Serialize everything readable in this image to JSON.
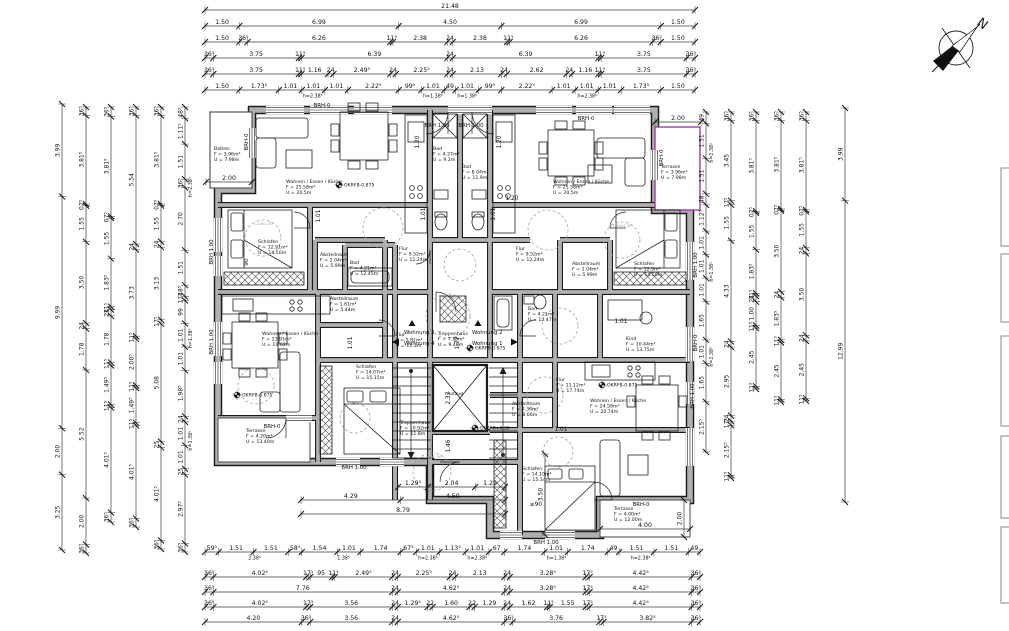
{
  "compass": {
    "label": "N"
  },
  "colors": {
    "line": "#1c1c1c",
    "wall_fill": "#b0b0b0",
    "chain": "#3a3a3a",
    "terrace_accent": "#a836a8",
    "dashed": "#9a9a9a"
  },
  "chains": [
    {
      "id": "t1",
      "dir": "h",
      "x": 205,
      "y": 10,
      "len": 490,
      "labels": [
        "21.48"
      ]
    },
    {
      "id": "t2",
      "dir": "h",
      "x": 205,
      "y": 26,
      "len": 490,
      "labels": [
        "1.50",
        "6.99",
        "4.50",
        "6.99",
        "1.50"
      ]
    },
    {
      "id": "t3",
      "dir": "h",
      "x": 205,
      "y": 42,
      "len": 490,
      "labels": [
        "1.50",
        "36⁵",
        "6.26",
        "11⁵",
        "2.38",
        "24",
        "2.38",
        "11⁵",
        "6.26",
        "36⁵",
        "1.50"
      ]
    },
    {
      "id": "t4",
      "dir": "h",
      "x": 205,
      "y": 58,
      "len": 490,
      "labels": [
        "36⁵",
        "3.75",
        "11⁵",
        "6.39",
        "24",
        "6.39",
        "11⁵",
        "3.75",
        "36⁵"
      ]
    },
    {
      "id": "t5",
      "dir": "h",
      "x": 205,
      "y": 74,
      "len": 490,
      "labels": [
        "36⁵",
        "3.75",
        "11⁵",
        "1.16",
        "24",
        "2.49⁵",
        "24",
        "2.25⁵",
        "24",
        "2.13",
        "24",
        "2.62",
        "24",
        "1.16",
        "11⁵",
        "3.75",
        "36⁵"
      ]
    },
    {
      "id": "t6",
      "dir": "h",
      "x": 205,
      "y": 90,
      "len": 490,
      "labels": [
        "1.50",
        "1.73⁵",
        "1.01",
        "1.01",
        "1.01",
        "2.22⁵",
        "99⁵",
        "1.01",
        "49",
        "1.01",
        "99⁵",
        "2.22⁵",
        "1.01",
        "1.01",
        "1.01",
        "1.73⁵",
        "1.50"
      ],
      "ann": [
        {
          "t": "h=2.38⁵",
          "f": 0.22
        },
        {
          "t": "h=1.38⁵",
          "f": 0.465
        },
        {
          "t": "h=1.38⁵",
          "f": 0.535
        },
        {
          "t": "h=2.38⁵",
          "f": 0.78
        }
      ]
    },
    {
      "id": "b1",
      "dir": "h",
      "x": 205,
      "y": 552,
      "len": 495,
      "labels": [
        "59⁵",
        "1.51",
        "1.51",
        "58⁵",
        "1.54",
        "1.01",
        "1.74",
        "67⁵",
        "1.01",
        "1.13⁵",
        "1.01",
        "67",
        "1.74",
        "1.01",
        "1.74",
        "49",
        "1.51",
        "1.51",
        "49"
      ],
      "ann": [
        {
          "t": "2.38⁵",
          "f": 0.1
        },
        {
          "t": "1.38⁵",
          "f": 0.28
        },
        {
          "t": "h=2.38⁵",
          "f": 0.45
        },
        {
          "t": "h=2.38⁵",
          "f": 0.55
        },
        {
          "t": "h=1.38⁵",
          "f": 0.71
        },
        {
          "t": "h=2.38⁵",
          "f": 0.88
        }
      ]
    },
    {
      "id": "b2",
      "dir": "h",
      "x": 205,
      "y": 577,
      "len": 495,
      "labels": [
        "36⁵",
        "4.02⁵",
        "17⁵",
        "95",
        "11⁵",
        "2.49⁵",
        "24",
        "2.25⁵",
        "24",
        "2.13",
        "24",
        "3.28⁵",
        "17⁵",
        "4.42⁵",
        "36⁵"
      ]
    },
    {
      "id": "b3",
      "dir": "h",
      "x": 205,
      "y": 592,
      "len": 495,
      "labels": [
        "36⁵",
        "7.76",
        "24",
        "4.62⁵",
        "24",
        "3.28⁵",
        "17⁵",
        "4.42⁵",
        "36⁵"
      ]
    },
    {
      "id": "b4",
      "dir": "h",
      "x": 205,
      "y": 607,
      "len": 495,
      "labels": [
        "36⁵",
        "4.02⁵",
        "17⁵",
        "3.56",
        "24",
        "1.29⁵",
        "22",
        "1.60",
        "22",
        "1.29",
        "24",
        "1.62",
        "11⁵",
        "1.55",
        "17⁵",
        "4.42⁵",
        "36⁵"
      ]
    },
    {
      "id": "b5",
      "dir": "h",
      "x": 205,
      "y": 622,
      "len": 495,
      "labels": [
        "4.20",
        "36⁵",
        "3.56",
        "24",
        "4.62⁵",
        "36⁵",
        "3.76",
        "17⁵",
        "3.82⁵",
        "36⁵"
      ]
    },
    {
      "id": "l1",
      "dir": "v",
      "x": 62,
      "y": 104,
      "len": 446,
      "labels": [
        "3.99",
        "9.99",
        "2.00",
        "3.25"
      ]
    },
    {
      "id": "l2",
      "dir": "v",
      "x": 86,
      "y": 107,
      "len": 446,
      "labels": [
        "36⁵",
        "3.81⁵",
        "07⁵",
        "1.55",
        "3.50",
        "24",
        "1.78",
        "5.52",
        "2.00",
        "36⁵"
      ]
    },
    {
      "id": "l3",
      "dir": "v",
      "x": 111,
      "y": 107,
      "len": 415,
      "labels": [
        "36⁵",
        "3.81⁵",
        "07⁵",
        "1.55",
        "1.83⁵",
        "11⁵",
        "24",
        "1.78",
        "11⁵",
        "1.49⁵",
        "11⁵",
        "4.01⁵",
        "36⁵"
      ]
    },
    {
      "id": "l4",
      "dir": "v",
      "x": 136,
      "y": 107,
      "len": 420,
      "labels": [
        "36⁵",
        "5.54",
        "24",
        "3.73",
        "11⁵",
        "2.00⁵",
        "11⁵",
        "1.49⁵",
        "11⁵",
        "4.01⁵",
        "36⁵"
      ]
    },
    {
      "id": "l5",
      "dir": "v",
      "x": 161,
      "y": 107,
      "len": 442,
      "labels": [
        "36⁵",
        "3.81⁵",
        "07⁵",
        "1.55",
        "24",
        "3.13",
        "17⁵",
        "5.08",
        "25",
        "4.01⁵",
        "36⁵"
      ]
    },
    {
      "id": "l6",
      "dir": "v",
      "x": 185,
      "y": 107,
      "len": 445,
      "labels": [
        "48⁵",
        "1.11⁵",
        "1.51",
        "36⁵",
        "2.70",
        "1.51",
        "48⁵",
        "17⁵",
        "99",
        "1.01",
        "1.01",
        "1.98⁵",
        "24",
        "1.01",
        "1.01",
        "25",
        "2.97⁵",
        "36⁵"
      ],
      "ann": [
        {
          "t": "h=2.38⁵",
          "f": 0.18
        },
        {
          "t": "h=1.38⁵",
          "f": 0.52
        },
        {
          "t": "h=1.38⁵",
          "f": 0.75
        }
      ]
    },
    {
      "id": "r1",
      "dir": "v",
      "x": 706,
      "y": 112,
      "len": 340,
      "labels": [
        "49",
        "1.51",
        "1.51",
        "48",
        "1.12⁵",
        "1.01",
        "1.01",
        "1.01",
        "1.65",
        "1.01",
        "1.65",
        "2.15⁵"
      ],
      "ann": [
        {
          "t": "h=2.38⁵",
          "f": 0.12
        },
        {
          "t": "h=1.38⁵",
          "f": 0.47
        },
        {
          "t": "h=2.38⁵",
          "f": 0.72
        }
      ]
    },
    {
      "id": "r2",
      "dir": "v",
      "x": 731,
      "y": 112,
      "len": 366,
      "labels": [
        "36⁵",
        "3.45",
        "17⁵",
        "1.55",
        "4.33",
        "24",
        "2.95",
        "24",
        "17⁵",
        "2.15⁵",
        "11⁵"
      ]
    },
    {
      "id": "r3",
      "dir": "v",
      "x": 756,
      "y": 112,
      "len": 277,
      "labels": [
        "36⁵",
        "3.81⁵",
        "07⁵",
        "1.55",
        "1.83⁵",
        "11⁵",
        "24",
        "1.00",
        "11⁵",
        "2.45",
        "11⁵"
      ]
    },
    {
      "id": "r4",
      "dir": "v",
      "x": 781,
      "y": 112,
      "len": 290,
      "labels": [
        "36⁵",
        "3.81⁵",
        "07⁵",
        "3.50",
        "24",
        "1.83⁵",
        "11⁵",
        "2.45",
        "11⁵"
      ]
    },
    {
      "id": "r5",
      "dir": "v",
      "x": 806,
      "y": 112,
      "len": 289,
      "labels": [
        "36⁵",
        "3.81⁵",
        "07⁵",
        "1.55",
        "24",
        "3.50",
        "24",
        "2.45",
        "11⁵"
      ]
    },
    {
      "id": "r6",
      "dir": "v",
      "x": 845,
      "y": 108,
      "len": 394,
      "labels": [
        "3.99",
        "12.99"
      ]
    },
    {
      "id": "p1",
      "dir": "h",
      "x": 398,
      "y": 487,
      "len": 107,
      "labels": [
        "1.29⁵",
        "2.04",
        "1.29"
      ]
    },
    {
      "id": "p2",
      "dir": "h",
      "x": 301,
      "y": 500,
      "len": 204,
      "labels": [
        "4.29",
        "4.50"
      ]
    },
    {
      "id": "p3",
      "dir": "h",
      "x": 301,
      "y": 514,
      "len": 204,
      "labels": [
        "8.79"
      ]
    },
    {
      "id": "p4",
      "dir": "v",
      "x": 545,
      "y": 454,
      "len": 81,
      "labels": [
        "3.50"
      ]
    },
    {
      "id": "p5",
      "dir": "h",
      "x": 600,
      "y": 529,
      "len": 90,
      "labels": [
        "4.00"
      ]
    },
    {
      "id": "p6",
      "dir": "v",
      "x": 684,
      "y": 500,
      "len": 37,
      "labels": [
        "2.00"
      ]
    },
    {
      "id": "p7",
      "dir": "h",
      "x": 655,
      "y": 122,
      "len": 46,
      "labels": [
        "2.00"
      ]
    },
    {
      "id": "p8",
      "dir": "h",
      "x": 206,
      "y": 182,
      "len": 46,
      "labels": [
        "2.00"
      ]
    }
  ],
  "rooms": [
    {
      "id": "balkon",
      "name": "Balkon",
      "area": "F = 3.96m²",
      "perim": "U = 7.98m",
      "x": 214,
      "y": 150
    },
    {
      "id": "wek-tl",
      "name": "Wohnen / Essen / Küche",
      "area": "F = 25.58m²",
      "perim": "U = 20.5m",
      "x": 286,
      "y": 183
    },
    {
      "id": "bad-1",
      "name": "Bad",
      "area": "F = 4.27m²",
      "perim": "U = 9.2m",
      "x": 433,
      "y": 150
    },
    {
      "id": "bad-2",
      "name": "Bad",
      "area": "F = 8.04m²",
      "perim": "U = 11.9m",
      "x": 462,
      "y": 168
    },
    {
      "id": "schlafen-tl",
      "name": "Schlafen",
      "area": "F = 12.91m²",
      "perim": "U = 14.50m",
      "x": 258,
      "y": 243
    },
    {
      "id": "abstell-tl",
      "name": "Abstellraum",
      "area": "F = 2.04m²",
      "perim": "U = 5.99m",
      "x": 320,
      "y": 256
    },
    {
      "id": "flur-tl",
      "name": "Flur",
      "area": "F = 9.52m²",
      "perim": "U = 12.24m",
      "x": 399,
      "y": 250
    },
    {
      "id": "terrasse-tr",
      "name": "Terrasse",
      "area": "F = 3.96m²",
      "perim": "U = 7.98m",
      "x": 661,
      "y": 168
    },
    {
      "id": "wek-tr",
      "name": "Wohnen / Essen / Küche",
      "area": "F = 25.58m²",
      "perim": "U = 20.5m",
      "x": 553,
      "y": 183
    },
    {
      "id": "schlafen-tr",
      "name": "Schlafen",
      "area": "F = 12.9m²",
      "perim": "U = 14.50m",
      "x": 634,
      "y": 265
    },
    {
      "id": "abstell-tr",
      "name": "Abstellraum",
      "area": "F = 2.04m²",
      "perim": "U = 5.99m",
      "x": 572,
      "y": 265
    },
    {
      "id": "flur-tr",
      "name": "Flur",
      "area": "F = 9.52m²",
      "perim": "U = 12.24m",
      "x": 516,
      "y": 250
    },
    {
      "id": "wek-bl",
      "name": "Wohnen / Essen / Küche",
      "area": "F = 23.91m²",
      "perim": "U = 19.62m",
      "x": 262,
      "y": 335
    },
    {
      "id": "abstell-bl",
      "name": "Abstellraum",
      "area": "F = 1.61m²",
      "perim": "U = 5.44m",
      "x": 330,
      "y": 300
    },
    {
      "id": "bad-bl",
      "name": "Bad",
      "area": "F = 4.21m²",
      "perim": "U = 12.45m",
      "x": 350,
      "y": 264
    },
    {
      "id": "flur-bl",
      "name": "Flur",
      "area": "F = 5.81m²",
      "perim": "U = 11.3m",
      "x": 396,
      "y": 336
    },
    {
      "id": "schlafen-bl",
      "name": "Schlafen",
      "area": "F = 14.07m²",
      "perim": "U = 15.15m",
      "x": 356,
      "y": 368
    },
    {
      "id": "terrasse-bl",
      "name": "Terrasse",
      "area": "F = 4.20m²",
      "perim": "U = 13.40m",
      "x": 246,
      "y": 432
    },
    {
      "id": "treppenhaus-1",
      "name": "Treppenhaus",
      "area": "F = 7.18m²",
      "perim": "U = 9.48m",
      "x": 438,
      "y": 335
    },
    {
      "id": "aufzug",
      "name": "Aufzug",
      "area": null,
      "perim": null,
      "x": 447,
      "y": 395
    },
    {
      "id": "treppenhaus-2",
      "name": "Treppenhaus",
      "area": "F = 10.92m²",
      "perim": "U = 11.8m",
      "x": 400,
      "y": 424
    },
    {
      "id": "bad-br",
      "name": "Bad",
      "area": "F = 4.21m²",
      "perim": "U = 12.47m",
      "x": 528,
      "y": 310
    },
    {
      "id": "kind",
      "name": "Kind",
      "area": "F = 10.44m²",
      "perim": "U = 13.75m",
      "x": 626,
      "y": 340
    },
    {
      "id": "flur-br",
      "name": "Flur",
      "area": "F = 11.12m²",
      "perim": "U = 17.74m",
      "x": 556,
      "y": 381
    },
    {
      "id": "abstell-br",
      "name": "Abstellraum",
      "area": "F = 4.36m²",
      "perim": "U = 8.66m",
      "x": 512,
      "y": 405
    },
    {
      "id": "wek-br",
      "name": "Wohnen / Essen / Küche",
      "area": "F = 24.58m²",
      "perim": "U = 20.74m",
      "x": 590,
      "y": 402
    },
    {
      "id": "schlafen-br",
      "name": "Schlafen",
      "area": "F = 14.10m²",
      "perim": "U = 15.14m",
      "x": 522,
      "y": 470
    },
    {
      "id": "terrasse-br",
      "name": "Terrasse",
      "area": "F = 4.00m²",
      "perim": "U = 12.00m",
      "x": 614,
      "y": 510
    }
  ],
  "brh": [
    {
      "t": "BRH-0",
      "x": 322,
      "y": 107
    },
    {
      "t": "BRH 1.00",
      "x": 437,
      "y": 127
    },
    {
      "t": "BRH 1.00",
      "x": 471,
      "y": 127
    },
    {
      "t": "BRH-0",
      "x": 586,
      "y": 120
    },
    {
      "t": "BRH-0",
      "x": 248,
      "y": 142,
      "r": -90
    },
    {
      "t": "BRH-0",
      "x": 663,
      "y": 158,
      "r": -90
    },
    {
      "t": "BRH 1.00",
      "x": 213,
      "y": 252,
      "r": -90
    },
    {
      "t": "BRH 1.00",
      "x": 213,
      "y": 342,
      "r": -90
    },
    {
      "t": "BRH 1.00",
      "x": 697,
      "y": 265,
      "r": -90
    },
    {
      "t": "BRH-0",
      "x": 697,
      "y": 343,
      "r": -90
    },
    {
      "t": "BRH 1.00",
      "x": 694,
      "y": 396,
      "r": -90
    },
    {
      "t": "BRH-0",
      "x": 272,
      "y": 428
    },
    {
      "t": "BRH 1.00",
      "x": 354,
      "y": 469
    },
    {
      "t": "BRH-0",
      "x": 641,
      "y": 506
    },
    {
      "t": "BRH 1.00",
      "x": 546,
      "y": 544
    }
  ],
  "okrfb": [
    {
      "t": "OKRFB-0.875",
      "x": 339,
      "y": 185
    },
    {
      "t": "OKRFB-0.875",
      "x": 237,
      "y": 395
    },
    {
      "t": "OKRFB-0.875",
      "x": 470,
      "y": 348
    },
    {
      "t": "OKRFB+0.38",
      "x": 475,
      "y": 428
    },
    {
      "t": "OKRFB-0.875",
      "x": 602,
      "y": 385
    }
  ],
  "wohnung": [
    {
      "t": "Wohnung 3",
      "x": 404,
      "y": 334,
      "anchor": "start",
      "tri": "up",
      "tx": 412,
      "ty": 324
    },
    {
      "t": "Wohnung 4",
      "x": 404,
      "y": 345,
      "anchor": "start",
      "tri": "left",
      "tx": 397,
      "ty": 342
    },
    {
      "t": "Wohnung 2",
      "x": 472,
      "y": 334,
      "anchor": "start",
      "tri": "up",
      "tx": 478,
      "ty": 324
    },
    {
      "t": "Wohnung 1",
      "x": 472,
      "y": 345,
      "anchor": "start",
      "tri": "right",
      "tx": 513,
      "ty": 342
    }
  ],
  "plan_dims": [
    {
      "t": "1.20",
      "x": 419,
      "y": 142,
      "r": -90
    },
    {
      "t": "1.20",
      "x": 501,
      "y": 142,
      "r": -90
    },
    {
      "t": "1.20",
      "x": 512,
      "y": 200
    },
    {
      "t": "1.01",
      "x": 320,
      "y": 216,
      "r": -90
    },
    {
      "t": "1.01",
      "x": 425,
      "y": 214,
      "r": -90
    },
    {
      "t": "1.01",
      "x": 495,
      "y": 214,
      "r": -90
    },
    {
      "t": "1.01",
      "x": 621,
      "y": 323
    },
    {
      "t": "90",
      "x": 248,
      "y": 262,
      "r": -90
    },
    {
      "t": "1.77",
      "x": 459,
      "y": 343,
      "r": -90
    },
    {
      "t": "2.37",
      "x": 450,
      "y": 398,
      "r": -90
    },
    {
      "t": "1.46",
      "x": 450,
      "y": 446,
      "r": -90
    },
    {
      "t": "1.01",
      "x": 561,
      "y": 431
    },
    {
      "t": "≥90",
      "x": 536,
      "y": 506
    },
    {
      "t": "1.01",
      "x": 352,
      "y": 343,
      "r": -90
    }
  ],
  "circles": [
    {
      "x": 383,
      "y": 228,
      "rr": 20,
      "label": ""
    },
    {
      "x": 548,
      "y": 230,
      "rr": 20,
      "label": ""
    },
    {
      "x": 460,
      "y": 265,
      "rr": 16,
      "label": ""
    },
    {
      "x": 263,
      "y": 238,
      "rr": 18,
      "label": "1.20x1.20"
    },
    {
      "x": 622,
      "y": 240,
      "rr": 18,
      "label": "1.20x1.20"
    },
    {
      "x": 448,
      "y": 316,
      "rr": 22,
      "label": "1.50x1.50"
    },
    {
      "x": 560,
      "y": 326,
      "rr": 18,
      "label": ""
    },
    {
      "x": 256,
      "y": 386,
      "rr": 18,
      "label": ""
    },
    {
      "x": 432,
      "y": 472,
      "rr": 19,
      "label": "1.50x1.50"
    },
    {
      "x": 558,
      "y": 452,
      "rr": 15,
      "label": ""
    },
    {
      "x": 545,
      "y": 395,
      "rr": 18,
      "label": ""
    },
    {
      "x": 355,
      "y": 418,
      "rr": 15,
      "label": ""
    }
  ]
}
